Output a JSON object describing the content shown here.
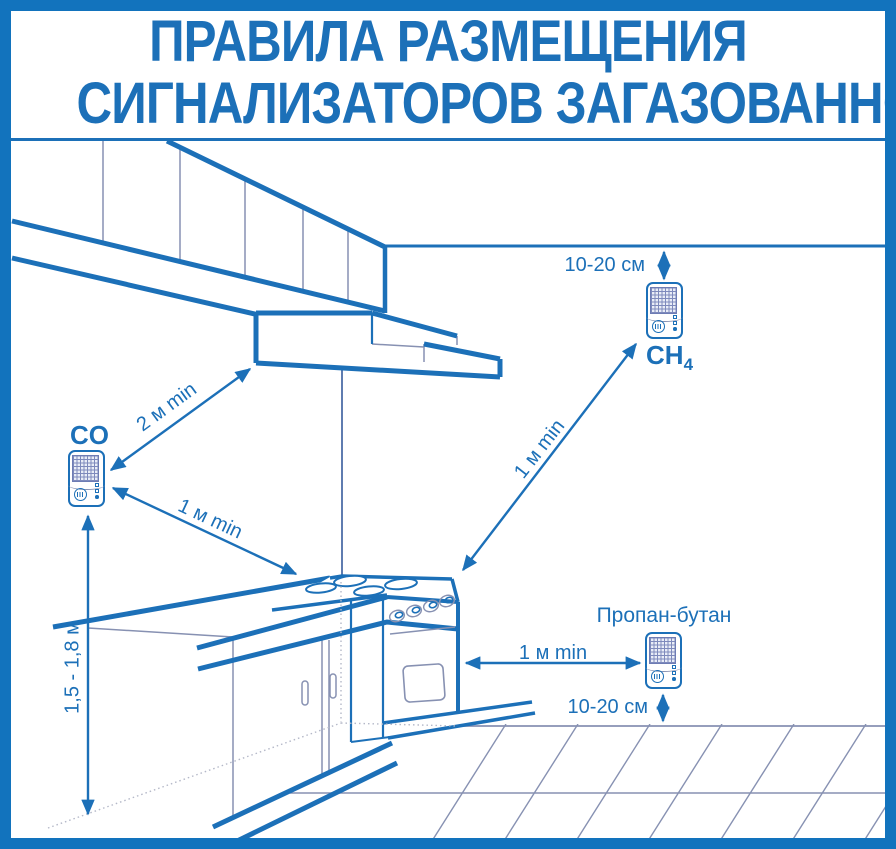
{
  "title": {
    "line1": "ПРАВИЛА РАЗМЕЩЕНИЯ",
    "line2": "СИГНАЛИЗАТОРОВ ЗАГАЗОВАННОСТИ"
  },
  "detectors": {
    "ch4": {
      "label_main": "CH",
      "label_sub": "4"
    },
    "co": {
      "label": "CO"
    },
    "propane": {
      "label": "Пропан-бутан"
    }
  },
  "dimensions": {
    "ceiling_offset": "10-20 см",
    "hood_min": "2 м min",
    "stove_min_co": "1 м min",
    "stove_min_ch4": "1 м min",
    "stove_min_propane": "1 м min",
    "mount_height": "1,5 - 1,8 м",
    "floor_offset": "10-20 см"
  },
  "colors": {
    "line_blue": "#1c70b8",
    "border_blue": "#1273bd",
    "thin_line_gray": "#8791b2"
  }
}
